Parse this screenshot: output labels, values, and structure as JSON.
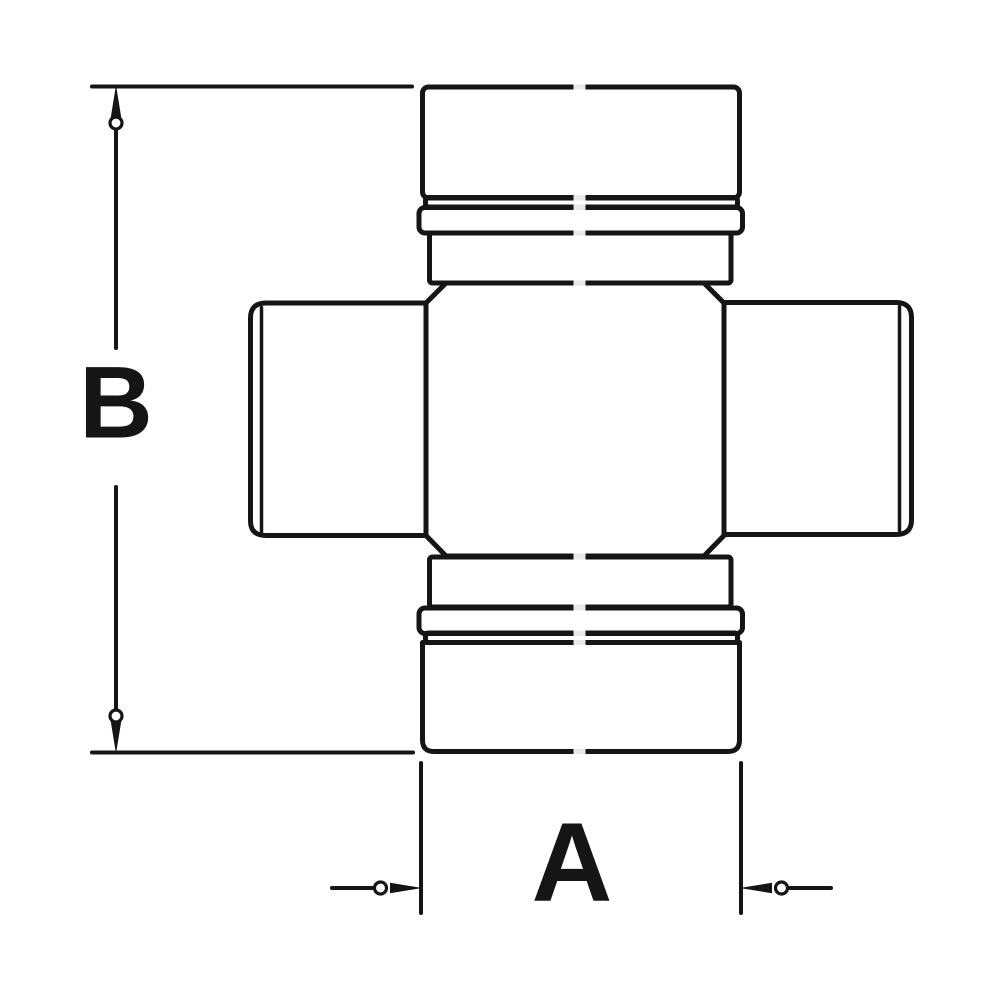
{
  "canvas": {
    "background_color": "#ffffff",
    "line_color": "#151515",
    "width_px": 1000,
    "height_px": 1000
  },
  "drawing": {
    "kind": "technical-line-drawing",
    "subject": "universal-joint-cross-with-four-bearing-caps",
    "arrow_style": "pointed-leader-with-open-circle-tail"
  },
  "dimensions": {
    "vertical": {
      "label": "B"
    },
    "horizontal": {
      "label": "A"
    }
  }
}
